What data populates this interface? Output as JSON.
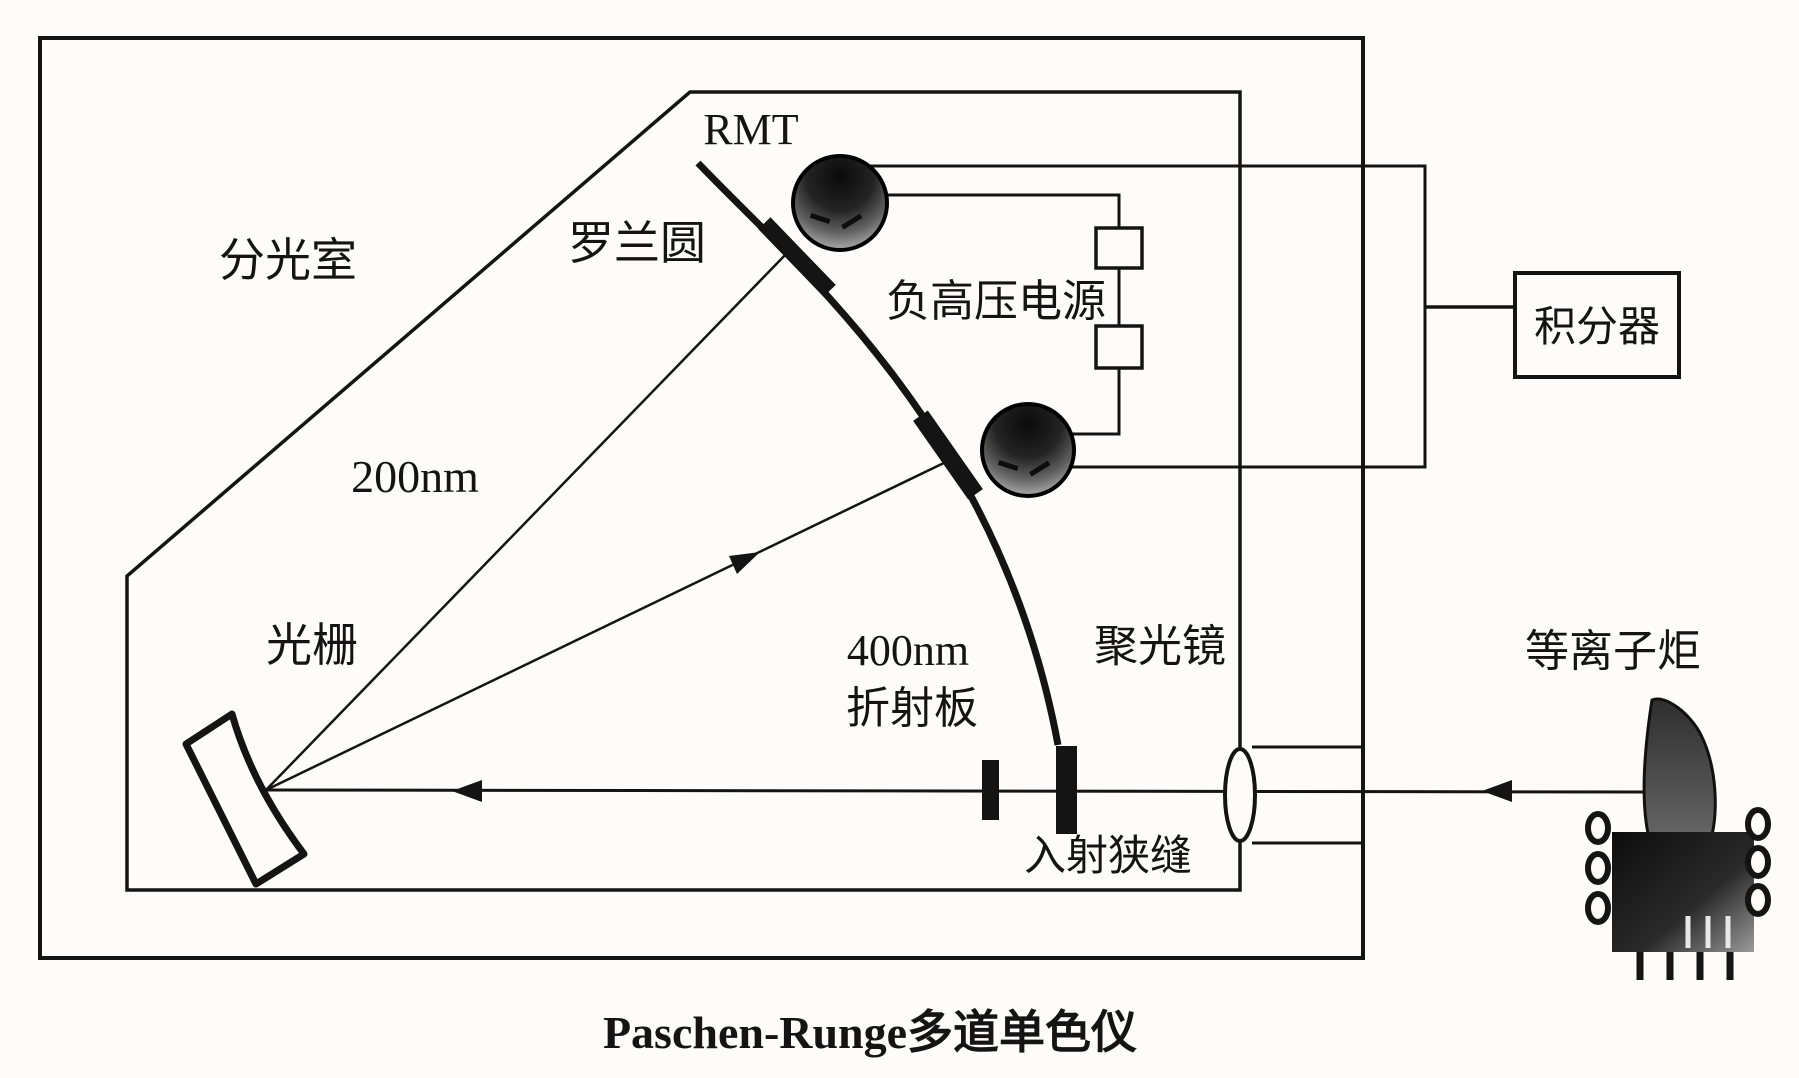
{
  "title": "Paschen-Runge多道单色仪",
  "colors": {
    "ink": "#141414",
    "paper": "#fdfcfb",
    "pmt_dark": "#0a0a0a",
    "pmt_light": "#d0d0d0"
  },
  "labels": {
    "chamber": "分光室",
    "rowland_circle": "罗兰圆",
    "rmt": "RMT",
    "hv_supply": "负高压电源",
    "integrator": "积分器",
    "wavelength_200": "200nm",
    "grating": "光栅",
    "wavelength_400": "400nm",
    "refraction_plate": "折射板",
    "condenser_lens": "聚光镜",
    "entrance_slit": "入射狭缝",
    "plasma_torch": "等离子炬"
  }
}
